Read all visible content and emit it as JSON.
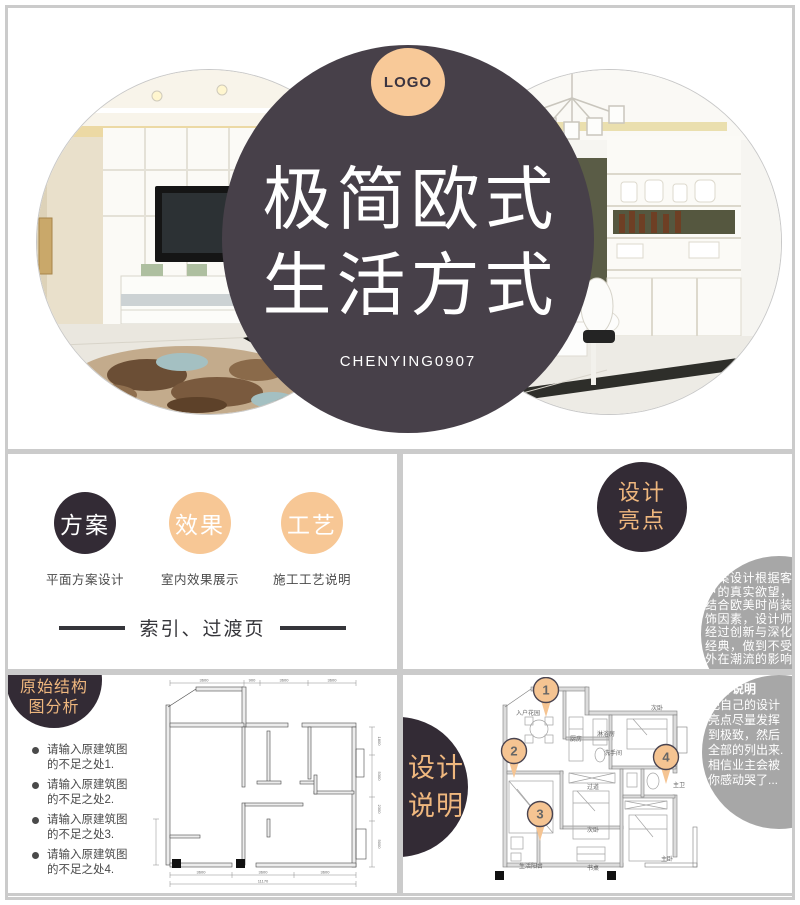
{
  "colors": {
    "frame_gray": "#cbcbcb",
    "title_circle_dark": "#474049",
    "badge_dark": "#332b35",
    "peach": "#f7c795",
    "orange_text": "#efb77e",
    "gray_circle": "#a7a7a7"
  },
  "title_slide": {
    "logo_label": "LOGO",
    "title_line1": "极简欧式",
    "title_line2": "生活方式",
    "subtitle": "CHENYING0907"
  },
  "index_slide": {
    "items": [
      {
        "circle_label": "方案",
        "caption": "平面方案设计"
      },
      {
        "circle_label": "效果",
        "caption": "室内效果展示"
      },
      {
        "circle_label": "工艺",
        "caption": "施工工艺说明"
      }
    ],
    "footer_label": "索引、过渡页"
  },
  "highlights_slide": {
    "badge_line1": "设计",
    "badge_line2": "亮点",
    "note_lines": [
      "本案设计根据客",
      "户的真实欲望，",
      "结合欧美时尚装",
      "饰因素，设计师",
      "经过创新与深化",
      "经典，做到不受",
      "外在潮流的影响"
    ]
  },
  "structure_slide": {
    "badge_line1": "原始结构",
    "badge_line2": "图分析",
    "bullets": [
      {
        "line1": "请输入原建筑图",
        "line2": "的不足之处1."
      },
      {
        "line1": "请输入原建筑图",
        "line2": "的不足之处2."
      },
      {
        "line1": "请输入原建筑图",
        "line2": "的不足之处3."
      },
      {
        "line1": "请输入原建筑图",
        "line2": "的不足之处4."
      }
    ],
    "plan_dims": {
      "top": [
        "3600",
        "900",
        "3600",
        "3600"
      ],
      "right": [
        "1800",
        "5300",
        "2300",
        "5000"
      ],
      "bottom": [
        "3600",
        "3600",
        "3600"
      ],
      "total": "11170"
    }
  },
  "description_slide": {
    "badge_line1": "设计",
    "badge_line2": "说明",
    "note_title": "设计说明",
    "note_lines": [
      "把自己的设计",
      "亮点尽量发挥",
      "到极致，然后",
      "全部的列出来.",
      "相信业主会被",
      "你感动哭了..."
    ],
    "pins": [
      "1",
      "2",
      "3",
      "4"
    ],
    "room_labels": [
      "入户花园",
      "厨房",
      "淋浴房",
      "洗手间",
      "次卧",
      "过道",
      "次卧",
      "主卫",
      "生活阳台",
      "书桌",
      "主卧"
    ]
  }
}
